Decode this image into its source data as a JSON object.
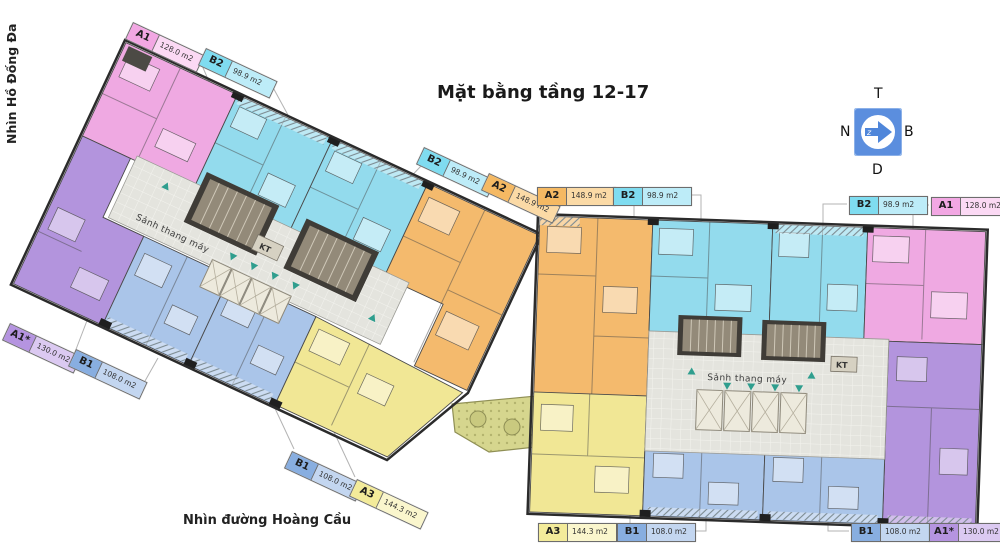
{
  "title": "Mặt bằng tầng 12-17",
  "street_labels": {
    "left_vertical": "Nhìn Hồ Đống Đa",
    "bottom": "Nhìn đường Hoàng Cầu"
  },
  "compass": {
    "top": "T",
    "right": "B",
    "bottom": "D",
    "left": "N",
    "arrow_mark": "z"
  },
  "core": {
    "lobby": "Sảnh thang máy",
    "kt": "KT"
  },
  "unit_labels": [
    {
      "code": "A1",
      "area": "128.0 m2"
    },
    {
      "code": "B2",
      "area": "98.9 m2"
    },
    {
      "code": "B2",
      "area": "98.9 m2"
    },
    {
      "code": "A2",
      "area": "148.9 m2"
    },
    {
      "code": "A2",
      "area": "148.9 m2"
    },
    {
      "code": "B2",
      "area": "98.9 m2"
    },
    {
      "code": "B2",
      "area": "98.9 m2"
    },
    {
      "code": "A1",
      "area": "128.0 m2"
    },
    {
      "code": "A1*",
      "area": "130.0 m2"
    },
    {
      "code": "B1",
      "area": "108.0 m2"
    },
    {
      "code": "B1",
      "area": "108.0 m2"
    },
    {
      "code": "A3",
      "area": "144.3 m2"
    },
    {
      "code": "A3",
      "area": "144.3 m2"
    },
    {
      "code": "B1",
      "area": "108.0 m2"
    },
    {
      "code": "B1",
      "area": "108.0 m2"
    },
    {
      "code": "A1*",
      "area": "130.0 m2"
    }
  ],
  "palette": {
    "A1": "#efa9e2",
    "A1*": "#b394dd",
    "A2": "#f4ba6d",
    "A3": "#f1e795",
    "B1": "#aac5e9",
    "B2": "#93dbed",
    "core_floor": "#e4e4de",
    "walls": "#2b2b2b",
    "entrance_arrow": "#2f9e8e",
    "compass_blue": "#5b8ede",
    "bridge": "#d6d68e"
  }
}
